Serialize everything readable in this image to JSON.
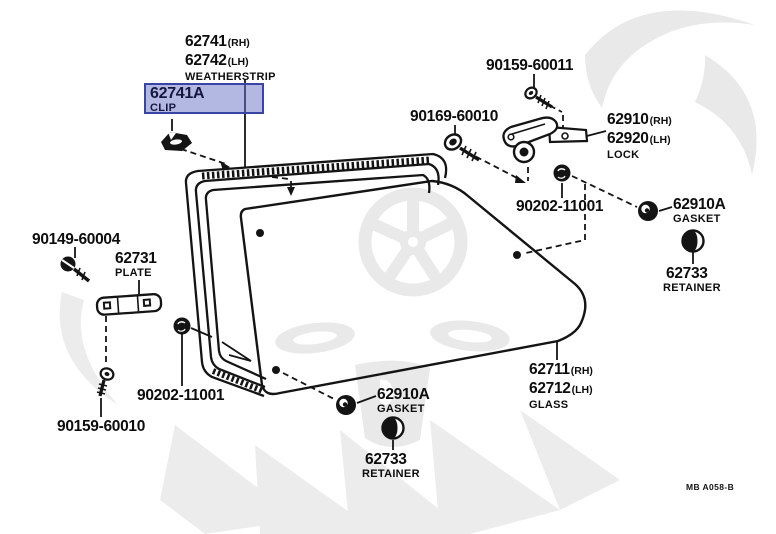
{
  "diagram": {
    "footer_code": "MB A058-B",
    "highlight": {
      "selected_part": "62741A",
      "fill": "rgba(104,113,199,0.5)",
      "border": "#3a44a5"
    },
    "parts": {
      "weatherstrip": {
        "number_rh": "62741",
        "side_rh": "(RH)",
        "number_lh": "62742",
        "side_lh": "(LH)",
        "name": "WEATHERSTRIP"
      },
      "clip": {
        "number": "62741A",
        "name": "CLIP"
      },
      "screw_upper": {
        "number": "90159-60011"
      },
      "bolt_lock": {
        "number": "90169-60010"
      },
      "lock": {
        "number_rh": "62910",
        "side_rh": "(RH)",
        "number_lh": "62920",
        "side_lh": "(LH)",
        "name": "LOCK"
      },
      "nut_upper": {
        "number": "90202-11001"
      },
      "gasket_upper": {
        "number": "62910A",
        "name": "GASKET"
      },
      "retainer_upper": {
        "number": "62733",
        "name": "RETAINER"
      },
      "screw_plate": {
        "number": "90149-60004"
      },
      "plate": {
        "number": "62731",
        "name": "PLATE"
      },
      "nut_lower": {
        "number": "90202-11001"
      },
      "screw_lower": {
        "number": "90159-60010"
      },
      "glass": {
        "number_rh": "62711",
        "side_rh": "(RH)",
        "number_lh": "62712",
        "side_lh": "(LH)",
        "name": "GLASS"
      },
      "gasket_lower": {
        "number": "62910A",
        "name": "GASKET"
      },
      "retainer_lower": {
        "number": "62733",
        "name": "RETAINER"
      }
    }
  }
}
